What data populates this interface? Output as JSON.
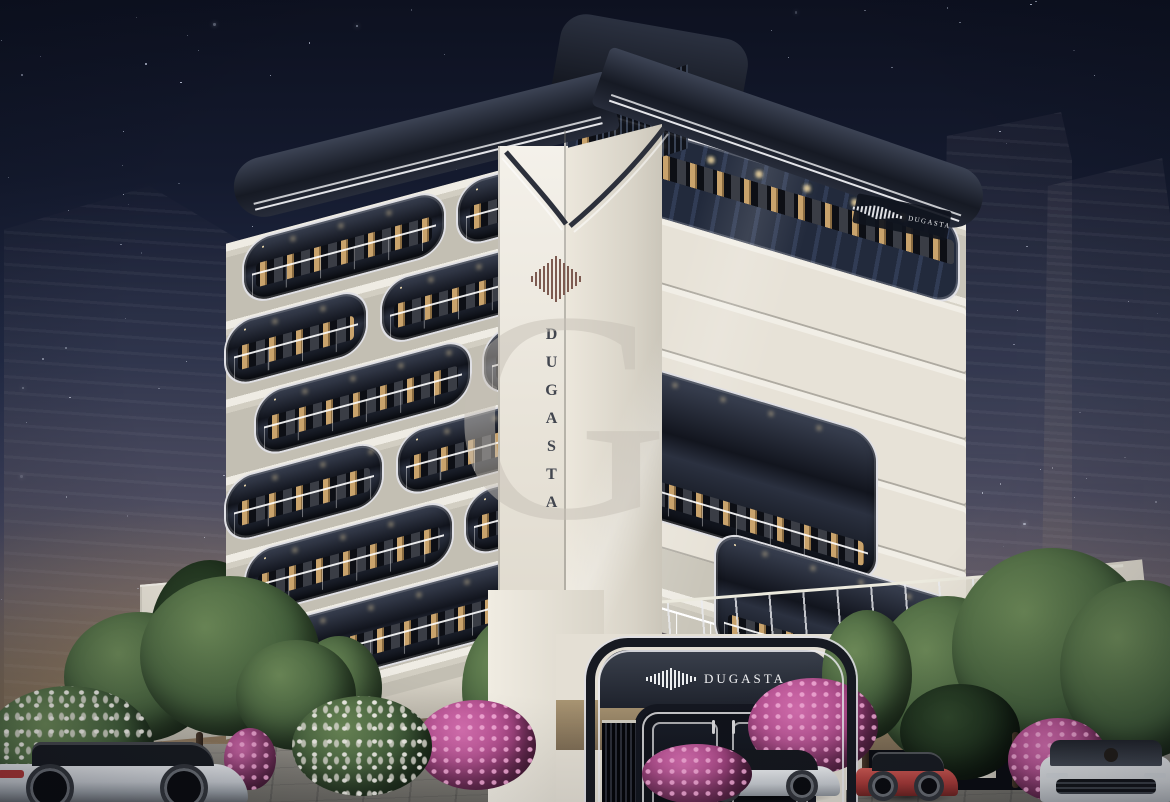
{
  "brand": {
    "name": "DUGASTA",
    "entrance_sign": "DUGASTA",
    "rooftop_sign": "DUGASTA"
  },
  "watermark": {
    "letter": "G"
  },
  "palette": {
    "sky_top": "#0d1120",
    "horizon_glow": "#7d6c54",
    "facade_light": "#ece8df",
    "facade_frame_dark": "#161a24",
    "window_glow": "#c9a36c",
    "logo_maroon": "#7d5a50",
    "flower_pink": "#b14a8c",
    "foliage_green": "#44603c",
    "car_red": "#a83a38"
  }
}
